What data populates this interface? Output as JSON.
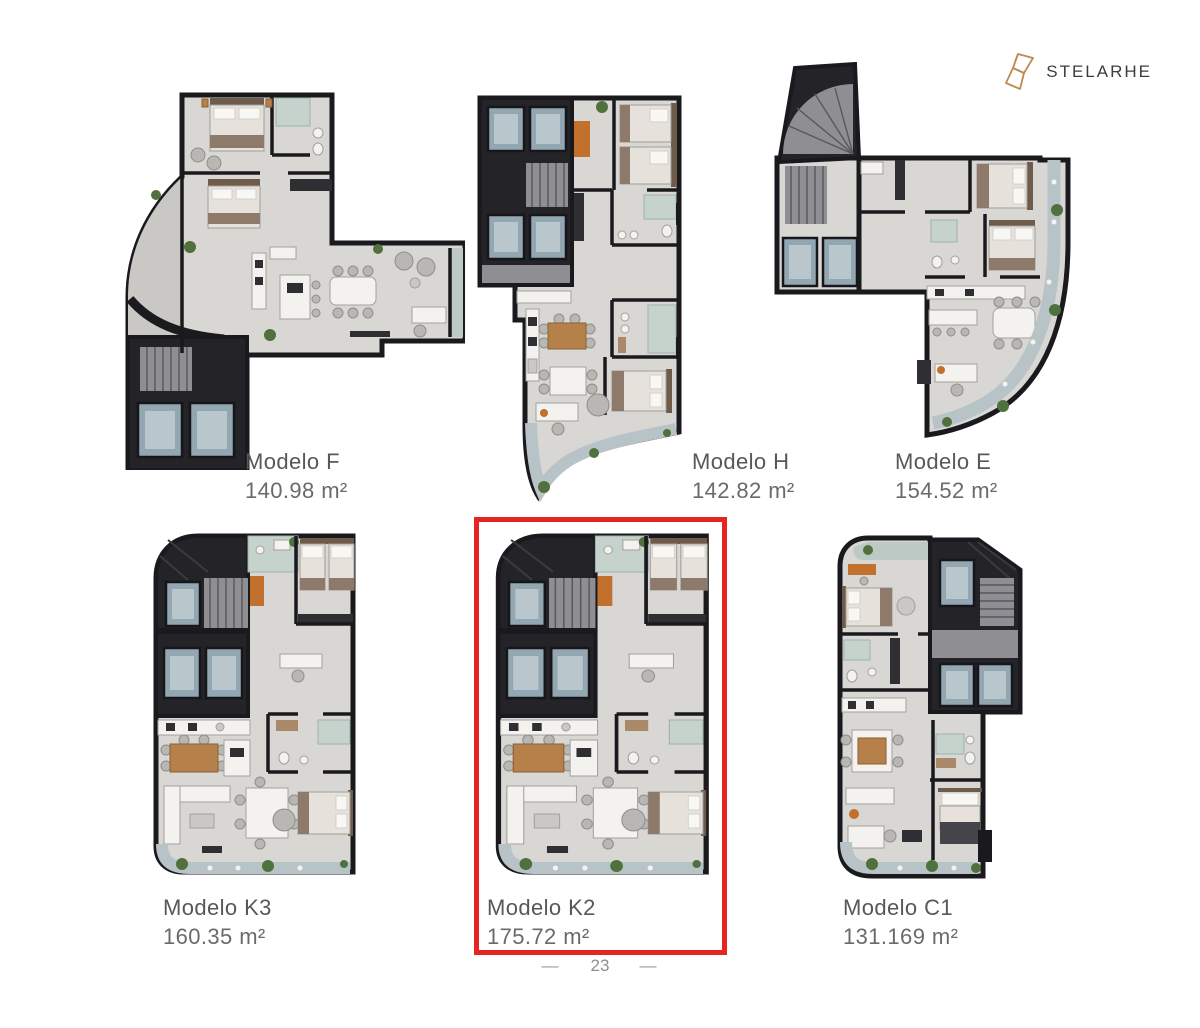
{
  "brand": {
    "name": "STELARHE"
  },
  "plans": [
    {
      "id": "modelo-f",
      "name": "Modelo F",
      "area": "140.98 m²",
      "highlighted": false
    },
    {
      "id": "modelo-h",
      "name": "Modelo H",
      "area": "142.82 m²",
      "highlighted": false
    },
    {
      "id": "modelo-e",
      "name": "Modelo E",
      "area": "154.52 m²",
      "highlighted": false
    },
    {
      "id": "modelo-k3",
      "name": "Modelo K3",
      "area": "160.35 m²",
      "highlighted": false
    },
    {
      "id": "modelo-k2",
      "name": "Modelo K2",
      "area": "175.72 m²",
      "highlighted": true
    },
    {
      "id": "modelo-c1",
      "name": "Modelo C1",
      "area": "131.169 m²",
      "highlighted": false
    }
  ],
  "page": {
    "number": "23",
    "dash": "—"
  },
  "colors": {
    "highlight": "#e62420",
    "logo_gold": "#c08a4f",
    "label_text": "#58585a",
    "footer_text": "#8f8f8f",
    "wall": "#1a1a1e",
    "floor": "#d8d7d4",
    "lift": "#92a7b1",
    "balcony": "#b7c3c6",
    "plant": "#50713e",
    "accent": "#c2702e"
  }
}
